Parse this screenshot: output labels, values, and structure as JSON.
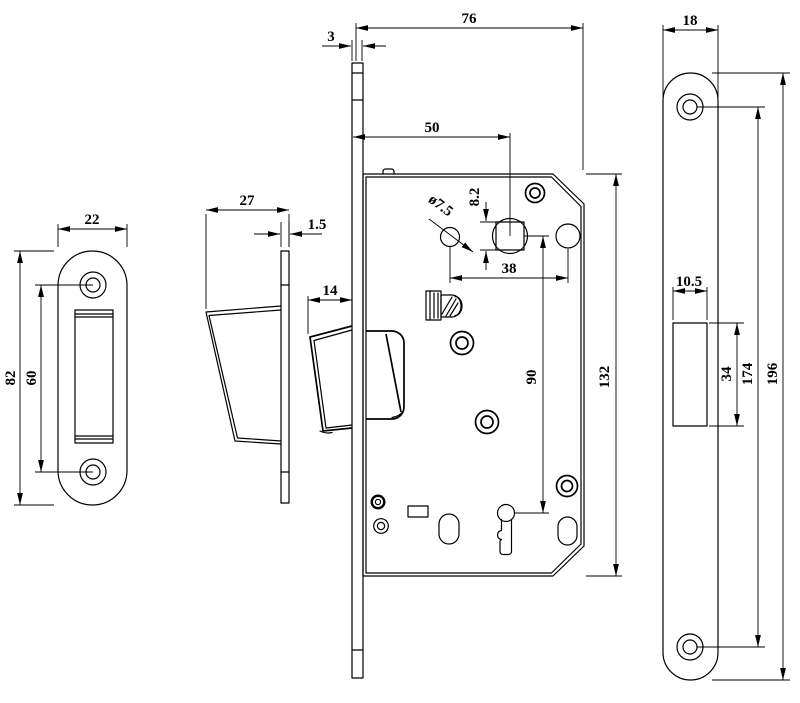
{
  "dims": {
    "strike": {
      "width": "22",
      "height": "82",
      "hole_spacing": "60"
    },
    "dustbox": {
      "depth": "27",
      "lip": "1.5"
    },
    "latch": {
      "projection": "14"
    },
    "body": {
      "face_thickness": "3",
      "depth": "76",
      "backset": "50",
      "square": "8.2",
      "hole_dia": "ø7.5",
      "hole_span": "38",
      "key_distance": "90",
      "height": "132"
    },
    "front": {
      "width": "18",
      "cutout_width": "10.5",
      "cutout_height": "34",
      "hole_spacing": "174",
      "height": "196"
    }
  }
}
